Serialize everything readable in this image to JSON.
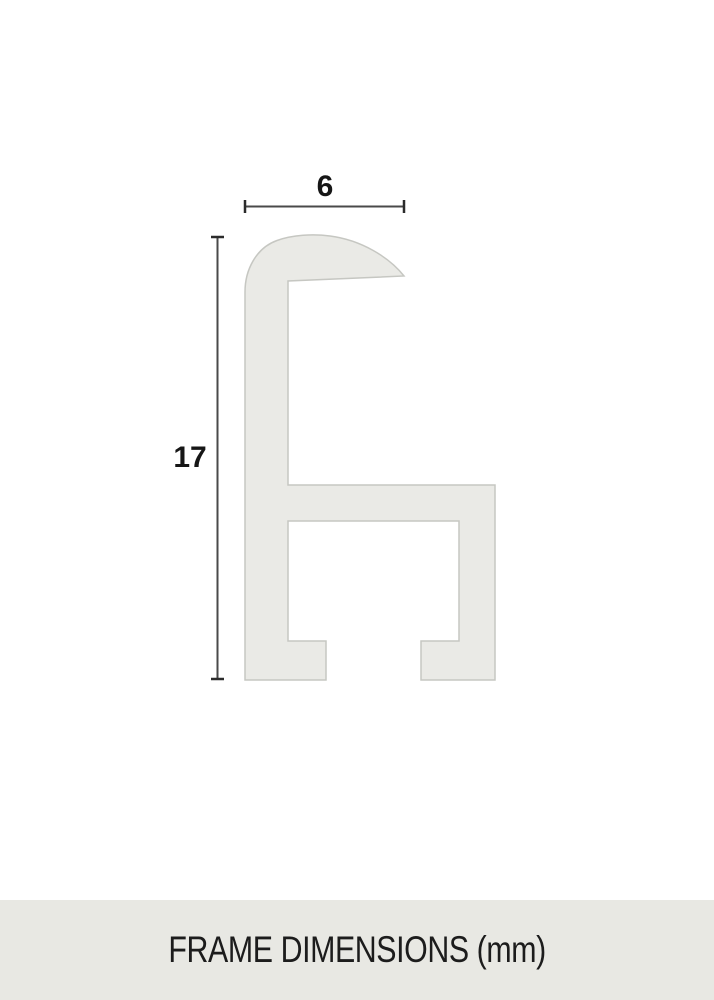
{
  "diagram": {
    "name": "frame-profile-cross-section",
    "width_dimension": {
      "value": "6"
    },
    "height_dimension": {
      "value": "17"
    },
    "colors": {
      "profile_fill": "#eaeae6",
      "profile_stroke": "#c6c7c2",
      "dimension_line": "#4a4a4a",
      "dimension_tick": "#2b2b2b",
      "dimension_text": "#161616"
    }
  },
  "footer": {
    "caption": "FRAME DIMENSIONS (mm)",
    "background": "#e8e8e3",
    "text_color": "#1c1c1c"
  }
}
